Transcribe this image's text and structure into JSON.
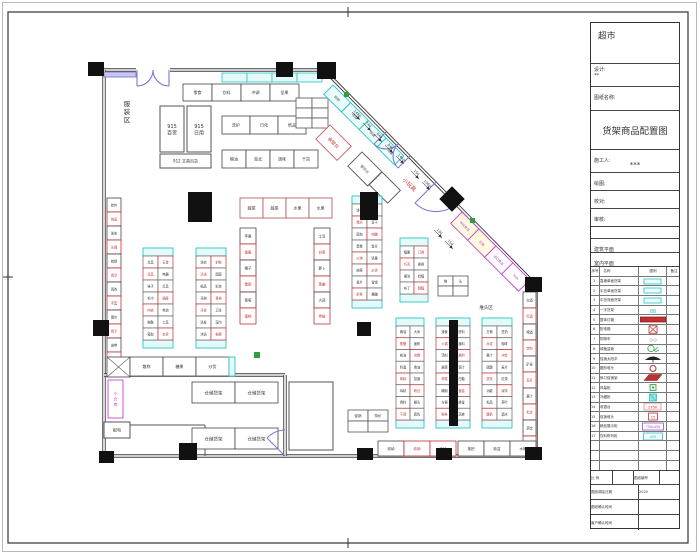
{
  "title_block": {
    "store_title": "超市",
    "design_label": "设计:",
    "design_value": "**",
    "sheet_name_label": "图纸名称:",
    "drawing_title": "货架商品配置图",
    "builder_label": "施工人:",
    "builder_value": "***",
    "draw_label": "绘图:",
    "check_label": "校对:",
    "audit_label": "审核:",
    "arch_plan_label": "建筑平面",
    "interior_plan_label": "室内平面",
    "scale_label": "比 例",
    "scale_value": "",
    "sheet_no_label": "图纸编号",
    "sheet_no_value": "",
    "draw_date_label": "图纸调绘日期",
    "draw_date_value": "2020",
    "confirm_label": "图纸确认时间",
    "confirm_value": "",
    "client_confirm_label": "客户确认时间",
    "client_confirm_value": ""
  },
  "legend": {
    "headers": [
      "序号",
      "名称",
      "图例",
      "备注"
    ],
    "rows": [
      {
        "no": "1",
        "name": "靠墙单面货架",
        "sym": "pill",
        "note": ""
      },
      {
        "no": "2",
        "name": "中岛单面货架",
        "sym": "pill",
        "note": ""
      },
      {
        "no": "3",
        "name": "中岛双面货架",
        "sym": "pill",
        "note": ""
      },
      {
        "no": "4",
        "name": "一字货架",
        "sym": "tealtext",
        "note": ""
      },
      {
        "no": "5",
        "name": "整体灯箱",
        "sym": "redbar",
        "note": ""
      },
      {
        "no": "6",
        "name": "配电箱",
        "sym": "redxbox",
        "note": ""
      },
      {
        "no": "7",
        "name": "购物车",
        "sym": "graytext",
        "note": ""
      },
      {
        "no": "8",
        "name": "绿植盆栽",
        "sym": "plant",
        "note": ""
      },
      {
        "no": "9",
        "name": "促销太阳伞",
        "sym": "umbrella",
        "note": ""
      },
      {
        "no": "10",
        "name": "圆形堆头",
        "sym": "ringred",
        "note": ""
      },
      {
        "no": "11",
        "name": "斜口促销架",
        "sym": "parared",
        "note": ""
      },
      {
        "no": "12",
        "name": "风幕柜",
        "sym": "boxgreen",
        "note": ""
      },
      {
        "no": "13",
        "name": "冷藏柜",
        "sym": "boxcyanfill",
        "note": ""
      },
      {
        "no": "14",
        "name": "收银台",
        "sym": "boxpink",
        "note": ""
      },
      {
        "no": "15",
        "name": "促销堆头",
        "sym": "boxredsm",
        "note": ""
      },
      {
        "no": "16",
        "name": "精品展示柜",
        "sym": "boxpurple",
        "note": ""
      },
      {
        "no": "17",
        "name": "饮料陈列柜",
        "sym": "boxcyanol",
        "note": ""
      },
      {
        "no": "",
        "name": "",
        "sym": "none",
        "note": ""
      },
      {
        "no": "",
        "name": "",
        "sym": "none",
        "note": ""
      },
      {
        "no": "",
        "name": "",
        "sym": "none",
        "note": ""
      }
    ]
  },
  "plan": {
    "colors": {
      "wall": "#3b3b3b",
      "door": "#7b7bcf",
      "teal": "#2cc4c4",
      "tealFill": "#e4fafa",
      "red": "#c03030",
      "magenta": "#c843c8",
      "green": "#2f9e3f",
      "ink": "#333333",
      "yellow": "#fffbe0"
    },
    "walls": [
      "M104,70 H136",
      "M170,70 H329",
      "M327,73 L536,285",
      "M536,285 V456",
      "M104,456 H536",
      "M104,70 V456",
      "M104,375 H285",
      "M285,375 V456"
    ],
    "thin_walls": [
      "M108,425 H205",
      "M205,425 V456",
      "M289,382 H333 V450 H289 Z"
    ],
    "doors": [
      "M137,70 L137,86 M137,86 A16 16 0 0 0 153,70 M169,70 L169,86 M169,86 A16 16 0 0 1 153,70",
      "M386,132 L374,144 M374,144 A17 17 0 0 0 398,144 M410,156 L398,168 M398,168 A17 17 0 0 1 398,144",
      "M436,182 L415,203 M457,203 A30 30 0 0 1 415,203",
      "M285,456 L267,438 M285,430 A26 26 0 0 0 267,438"
    ],
    "columns": [
      [
        88,
        62,
        16,
        14
      ],
      [
        276,
        62,
        17,
        15
      ],
      [
        317,
        62,
        19,
        17
      ],
      [
        525,
        277,
        17,
        15
      ],
      [
        525,
        447,
        17,
        13
      ],
      [
        436,
        448,
        16,
        12
      ],
      [
        357,
        448,
        16,
        12
      ],
      [
        179,
        443,
        18,
        17
      ],
      [
        99,
        451,
        15,
        12
      ],
      [
        93,
        320,
        16,
        16
      ],
      [
        188,
        192,
        24,
        30
      ],
      [
        360,
        192,
        18,
        28
      ],
      [
        357,
        322,
        14,
        14
      ],
      [
        449,
        320,
        9,
        106
      ],
      [
        443,
        190,
        18,
        18,
        45
      ]
    ],
    "greens": [
      [
        344,
        92,
        5,
        5
      ],
      [
        470,
        218,
        5,
        5
      ],
      [
        254,
        352,
        6,
        6
      ]
    ],
    "shelves": [
      {
        "k": "rect",
        "x": 104,
        "y": 72,
        "w": 32,
        "h": 5,
        "f": "#c8c8ee",
        "s": "#7b7bcf"
      },
      {
        "k": "row",
        "x": 222,
        "y": 73,
        "cw": 25,
        "ch": 9,
        "n": 4,
        "f": "#e4fafa",
        "s": "#2cc4c4",
        "labels": ""
      },
      {
        "k": "row",
        "x": 183,
        "y": 84,
        "cw": 29,
        "ch": 17,
        "labels": "零食|饮料|冲调|坚果",
        "fs": 4
      },
      {
        "k": "rect",
        "x": 160,
        "y": 106,
        "w": 24,
        "h": 46,
        "lines": [
          "915",
          "百货"
        ],
        "fs": 5
      },
      {
        "k": "rect",
        "x": 187,
        "y": 106,
        "w": 24,
        "h": 46,
        "lines": [
          "915",
          "日用"
        ],
        "fs": 5
      },
      {
        "k": "rect",
        "x": 160,
        "y": 154,
        "w": 51,
        "h": 14,
        "lines": [
          "912 文具百货"
        ],
        "fs": 4
      },
      {
        "k": "row",
        "x": 222,
        "y": 116,
        "cw": 28,
        "ch": 18,
        "labels": "洗护|日化|纸品",
        "fs": 4
      },
      {
        "k": "row",
        "x": 222,
        "y": 150,
        "cw": 24,
        "ch": 18,
        "labels": "粮油|南北|调味|干货",
        "fs": 4
      },
      {
        "k": "grid",
        "x": 296,
        "y": 98,
        "cw": 16,
        "ch": 10,
        "cols": 2,
        "rows": 3
      },
      {
        "k": "rotrow",
        "x": 333,
        "y": 85,
        "cw": 25,
        "ch": 13,
        "labels": "奶粉|母婴|保健|礼盒",
        "s": "#2cc4c4",
        "f": "#eafcfc",
        "lc": "#555",
        "fs": 3.5
      },
      {
        "k": "rotrect",
        "x": 330,
        "y": 125,
        "w": 30,
        "h": 20,
        "label": "收银台",
        "s": "#c06060",
        "lc": "#c03030",
        "fs": 4.5
      },
      {
        "k": "rotrect",
        "x": 362,
        "y": 152,
        "w": 28,
        "h": 20,
        "label": "服务台",
        "s": "#555",
        "lc": "#555",
        "fs": 3.5
      },
      {
        "k": "rotrect",
        "x": 382,
        "y": 172,
        "w": 26,
        "h": 18,
        "label": "",
        "s": "#555",
        "lc": "#555",
        "fs": 3.5
      },
      {
        "k": "rotrow",
        "x": 462,
        "y": 212,
        "cw": 24,
        "ch": 16,
        "labels": "休闲食品|红酒|进口食品|牛奶",
        "s": "#c843c8",
        "lc": "#c843c8",
        "fs": 3.2,
        "f0": "#fffbe0"
      },
      {
        "k": "g",
        "x": 143,
        "y": 248,
        "w": 30,
        "h": 100,
        "rows": 7,
        "labels": "文具|玩具|袜子|毛巾|内衣|拖鞋|箱包|五金|电器|灯具|插座|电池|工具|杂货"
      },
      {
        "k": "g",
        "x": 196,
        "y": 248,
        "w": 30,
        "h": 100,
        "rows": 7,
        "labels": "洗衣|清洁|纸品|牙刷|牙膏|洗发|沐浴|护肤|面膜|彩妆|香皂|卫生|湿巾|棉柔"
      },
      {
        "k": "g",
        "x": 352,
        "y": 196,
        "w": 30,
        "h": 112,
        "rows": 8,
        "labels": "饼干|糕点|面包|蛋卷|沙琪|曲奇|薯片|虾条|锅巴|豆干|肉脯|鱼仔|坚果|炒货|蜜饯|果脯"
      },
      {
        "k": "g",
        "x": 400,
        "y": 238,
        "w": 28,
        "h": 64,
        "rows": 4,
        "labels": "糖果|巧克|果冻|布丁|口香|棒棒|奶糖|酥糖"
      },
      {
        "k": "g",
        "x": 396,
        "y": 318,
        "w": 28,
        "h": 110,
        "rows": 8,
        "labels": "酱油|陈醋|蚝油|料酒|味精|鸡精|香料|干调|大米|面粉|杂粮|食油|挂面|粉丝|罐头|腐乳"
      },
      {
        "k": "g",
        "x": 436,
        "y": 318,
        "w": 34,
        "h": 110,
        "rows": 8,
        "labels": "速食|火锅|汤料|酱菜|榨菜|腌制|方便|粉条|底料|蘸料|酱料|调汁|白糖|食盐|蜂蜜|芝麻"
      },
      {
        "k": "g",
        "x": 482,
        "y": 318,
        "w": 30,
        "h": 110,
        "rows": 8,
        "labels": "方便|水饮|果汁|碳酸|茶饮|功能|乳品|酸奶|豆奶|咖啡|冲饮|麦片|红茶|绿茶|茶叶|酒水"
      },
      {
        "k": "row",
        "x": 240,
        "y": 198,
        "cw": 23,
        "ch": 20,
        "labels": "蔬菜|蔬菜|水果|水果",
        "s": "#b05050",
        "fs": 4
      },
      {
        "k": "vrow",
        "x": 240,
        "y": 228,
        "cw": 16,
        "ch": 16,
        "labels": "苹果|香蕉|橙子|雪梨|葡萄|蜜桃",
        "fs": 3.5
      },
      {
        "k": "vrow",
        "x": 314,
        "y": 228,
        "cw": 16,
        "ch": 16,
        "labels": "土豆|白菜|萝卜|葱姜|大蒜|青椒",
        "fs": 3.5
      },
      {
        "k": "vrow",
        "x": 107,
        "y": 198,
        "cw": 14,
        "ch": 14,
        "labels": "挂件|饰品|发夹|头绳|梳镜|雨伞|雨衣|手套|围巾|帽子|皮带|钱包",
        "fs": 3.2
      },
      {
        "k": "vrow",
        "x": 523,
        "y": 292,
        "cw": 13,
        "ch": 16,
        "labels": "白酒|红酒|啤酒|饮料|矿泉|苏打|果汁|乳饮|茶饮|凉茶",
        "fs": 3.2
      },
      {
        "k": "xbox",
        "x": 107,
        "y": 357,
        "w": 23,
        "h": 20
      },
      {
        "k": "row",
        "x": 130,
        "y": 357,
        "cw": 33,
        "ch": 19,
        "labels": "散称|糖果|炒货",
        "fs": 4
      },
      {
        "k": "rect",
        "x": 229,
        "y": 357,
        "w": 6,
        "h": 19,
        "f": "#e4fafa",
        "s": "#2cc4c4"
      },
      {
        "k": "row",
        "x": 192,
        "y": 382,
        "cw": 43,
        "ch": 21,
        "labels": "仓储货架|仓储货架",
        "fs": 4.5
      },
      {
        "k": "row",
        "x": 192,
        "y": 428,
        "cw": 43,
        "ch": 21,
        "labels": "仓储货架|仓储货架",
        "fs": 4.5
      },
      {
        "k": "rect",
        "x": 108,
        "y": 380,
        "w": 15,
        "h": 38,
        "s": "#c843c8",
        "lines": [
          "小",
          "仓",
          "库"
        ],
        "lc": "#c843c8",
        "fs": 4
      },
      {
        "k": "rect",
        "x": 104,
        "y": 422,
        "w": 26,
        "h": 16,
        "lines": [
          "配电"
        ],
        "fs": 4
      },
      {
        "k": "row",
        "x": 378,
        "y": 441,
        "cw": 26,
        "ch": 15,
        "labels": "收纳|收纳|收纳",
        "reds": [
          1,
          2
        ],
        "fs": 3.5
      },
      {
        "k": "row",
        "x": 458,
        "y": 441,
        "cw": 26,
        "ch": 15,
        "labels": "拖把|脸盆|水桶",
        "fs": 3.5
      },
      {
        "k": "grid",
        "x": 438,
        "y": 276,
        "cw": 15,
        "ch": 10,
        "cols": 2,
        "rows": 2,
        "labels": "堆|头",
        "fs": 3.5
      },
      {
        "k": "grid",
        "x": 348,
        "y": 410,
        "cw": 20,
        "ch": 11,
        "cols": 2,
        "rows": 2,
        "labels": "促销|特价",
        "fs": 3.5
      }
    ],
    "dims": [
      {
        "x": 352,
        "y": 112,
        "t": "1480"
      },
      {
        "x": 363,
        "y": 123,
        "t": "740"
      },
      {
        "x": 374,
        "y": 134,
        "t": "640"
      },
      {
        "x": 385,
        "y": 145,
        "t": "840"
      },
      {
        "x": 396,
        "y": 156,
        "t": "1460"
      },
      {
        "x": 411,
        "y": 171,
        "t": "150"
      },
      {
        "x": 422,
        "y": 182,
        "t": "1060"
      },
      {
        "x": 434,
        "y": 230,
        "t": "130"
      },
      {
        "x": 445,
        "y": 241,
        "t": "150"
      }
    ],
    "labels": [
      {
        "t": "服装区",
        "x": 127,
        "y": 106,
        "fs": 6.5,
        "vert": true,
        "c": "#333333"
      },
      {
        "t": "小玩具",
        "x": 408,
        "y": 186,
        "fs": 5.5,
        "rot": 45,
        "c": "#c03030"
      },
      {
        "t": "堆头区",
        "x": 486,
        "y": 309,
        "fs": 4.5,
        "c": "#333333"
      }
    ]
  }
}
